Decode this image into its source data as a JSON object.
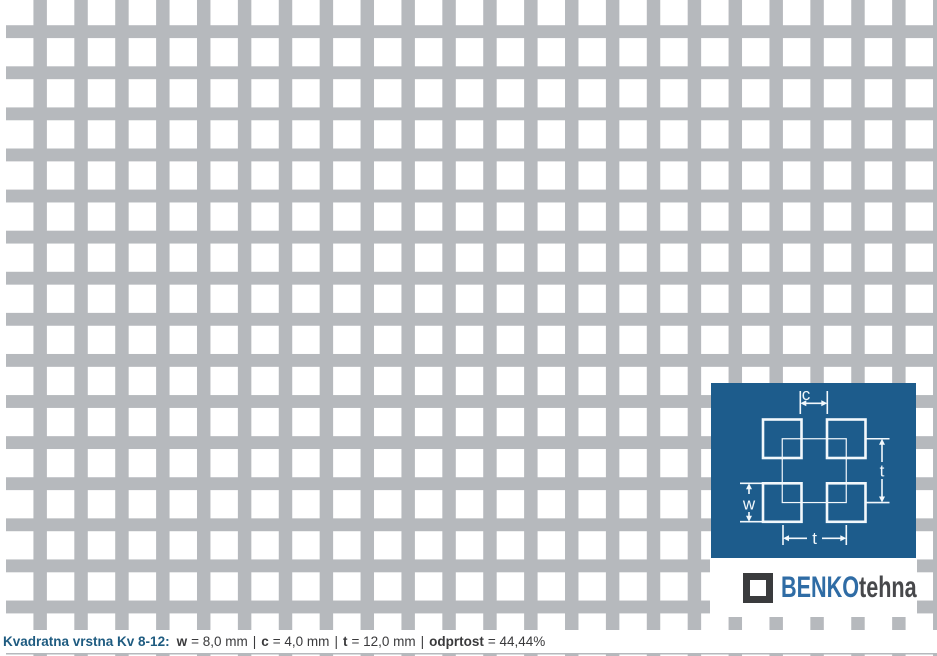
{
  "pattern": {
    "name": "square-perforation-grid",
    "description": "perforated sheet, square holes in straight rows",
    "hole_color": "#ffffff",
    "web_color": "#b6b9bd"
  },
  "diagram": {
    "labels": {
      "c": "c",
      "t_vertical": "t",
      "w": "w",
      "t_horizontal": "t"
    }
  },
  "logo": {
    "icon": "square-outline-icon",
    "brand_primary": "BENKO",
    "brand_secondary": "tehna"
  },
  "caption": {
    "title": "Kvadratna vrstna Kv 8-12:",
    "separator": "|",
    "specs": [
      {
        "key": "w",
        "value": "= 8,0 mm"
      },
      {
        "key": "c",
        "value": "= 4,0 mm"
      },
      {
        "key": "t",
        "value": "= 12,0 mm"
      },
      {
        "key": "odprtost",
        "value": "= 44,44%"
      }
    ]
  },
  "colors": {
    "grid-gray": "#b6b9bd",
    "panel-blue": "#1d5c8c",
    "diagram-line": "#f2f8fc",
    "caption-blue": "#1e5b80",
    "text-dark": "#3a3a3c",
    "brand-blue": "#2f6ca5",
    "brand-dark": "#47484b",
    "logo-icon-dark": "#3a3b3d",
    "background-white": "#ffffff"
  }
}
